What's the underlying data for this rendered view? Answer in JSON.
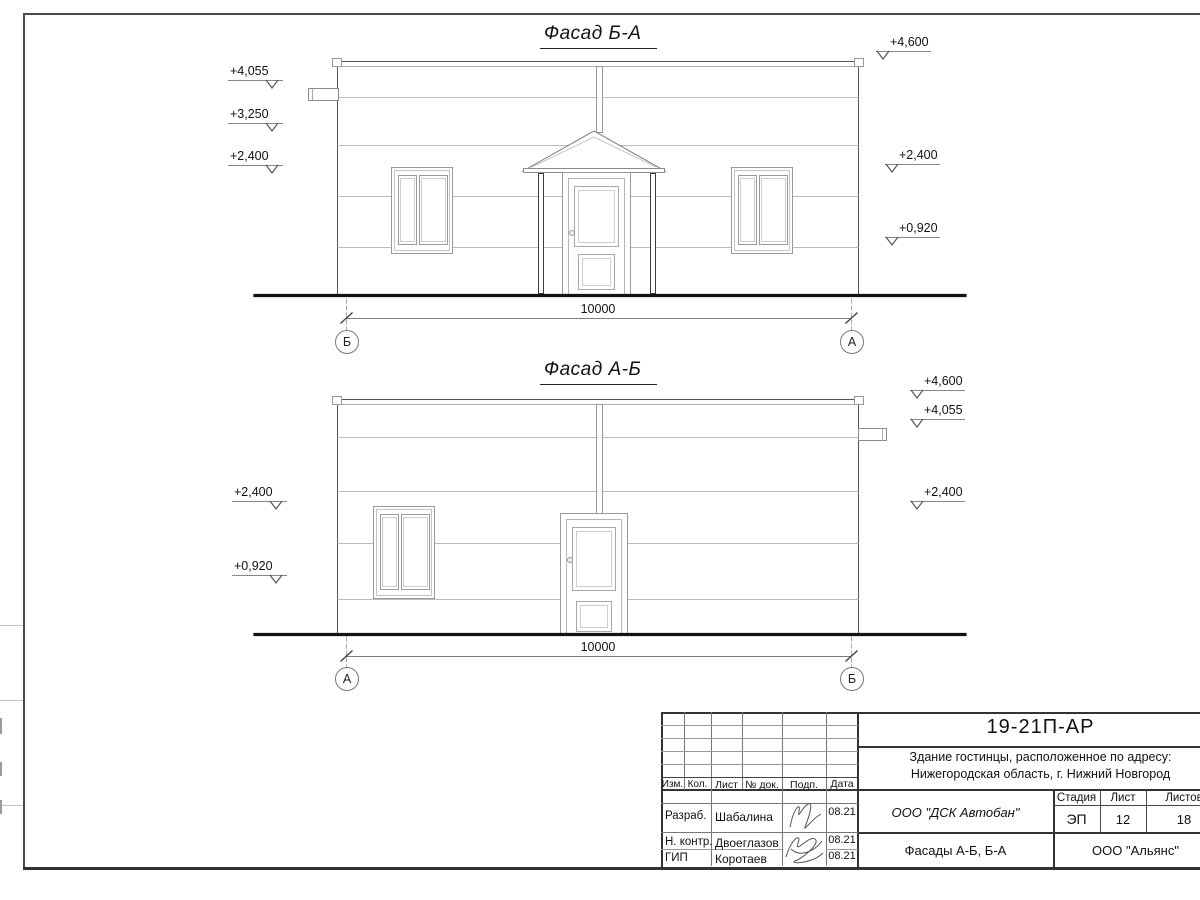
{
  "facade_top": {
    "title": "Фасад Б-А",
    "dimension": "10000",
    "axis_left": "Б",
    "axis_right": "А",
    "marks_left": [
      "+4,055",
      "+3,250",
      "+2,400"
    ],
    "marks_right": [
      "+4,600",
      "+2,400",
      "+0,920"
    ]
  },
  "facade_bottom": {
    "title": "Фасад А-Б",
    "dimension": "10000",
    "axis_left": "А",
    "axis_right": "Б",
    "marks_left": [
      "+2,400",
      "+0,920"
    ],
    "marks_right": [
      "+4,600",
      "+4,055",
      "+2,400"
    ]
  },
  "title_block": {
    "doc_code": "19-21П-АР",
    "project_line1": "Здание гостинцы, расположенное по адресу:",
    "project_line2": "Нижегородская область, г. Нижний Новгород",
    "columns": {
      "izm": "Изм.",
      "kol": "Кол.",
      "list": "Лист",
      "doc": "№ док.",
      "podp": "Подп.",
      "data": "Дата"
    },
    "rows": [
      {
        "role": "Разраб.",
        "name": "Шабалина",
        "date": "08.21"
      },
      {
        "role": "Н. контр.",
        "name": "Двоеглазов",
        "date": "08.21"
      },
      {
        "role": "ГИП",
        "name": "Коротаев",
        "date": "08.21"
      }
    ],
    "company": "ООО \"ДСК Автобан\"",
    "stage_label": "Стадия",
    "sheet_label": "Лист",
    "sheets_label": "Листов",
    "stage": "ЭП",
    "sheet_no": "12",
    "sheets_total": "18",
    "drawing_title": "Фасады А-Б, Б-А",
    "contractor": "ООО \"Альянс\""
  },
  "colors": {
    "frame": "#3a3a3a",
    "line_dark": "#444444",
    "line_mid": "#888888",
    "line_light": "#bcbcbc",
    "ground": "#141414"
  }
}
